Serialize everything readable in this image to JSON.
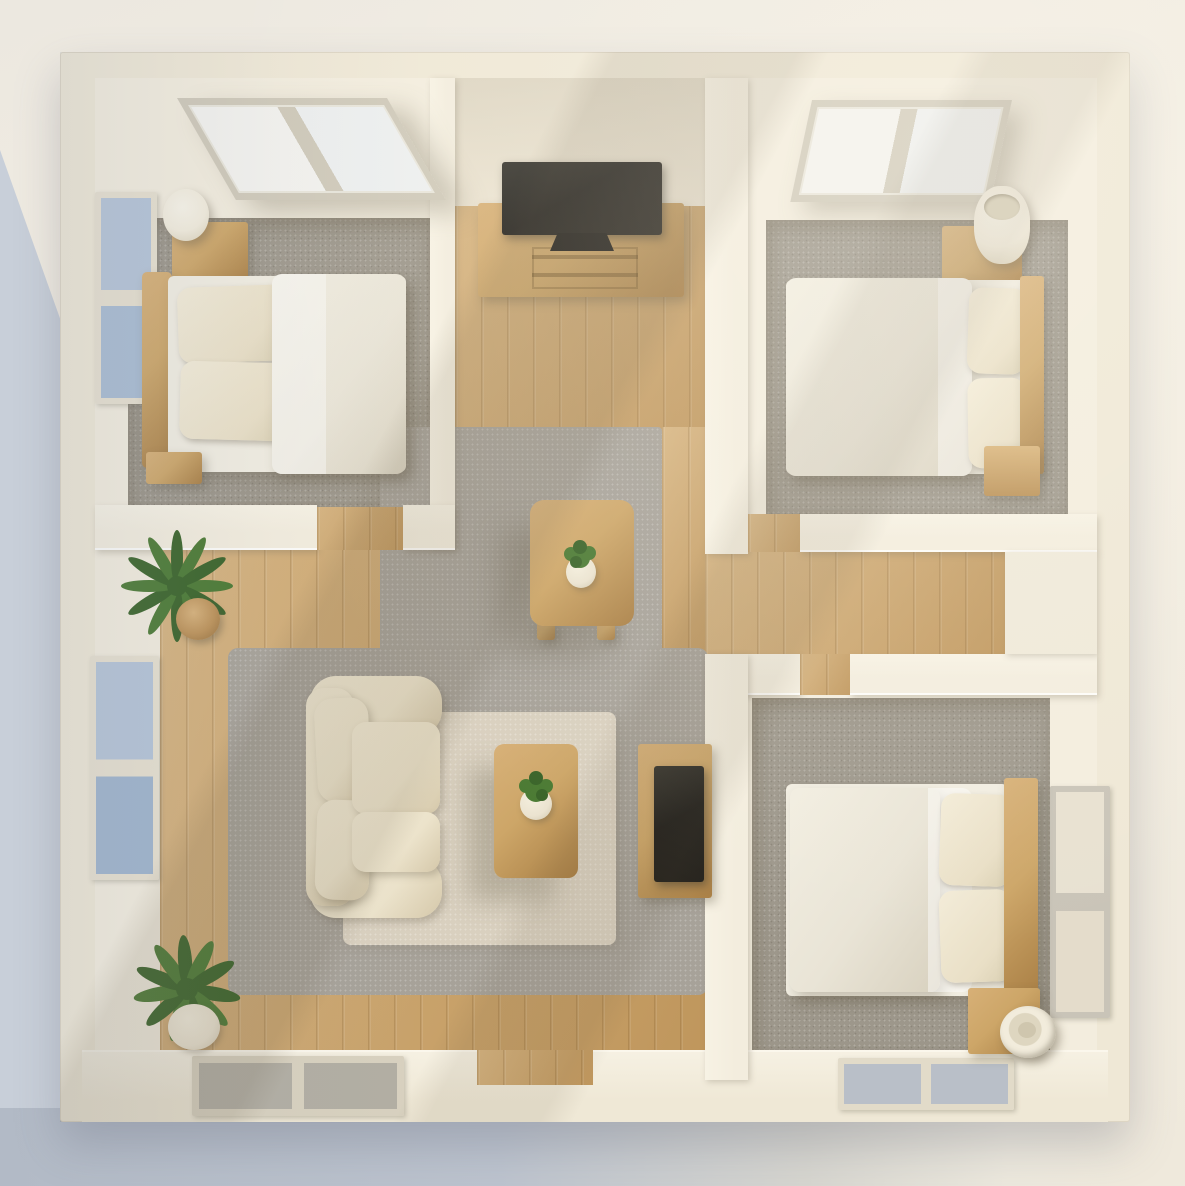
{
  "scene": {
    "title": "3D top-down floor plan render of a small apartment",
    "render_style": "photorealistic top-down axonometric, no visible text",
    "rooms": [
      {
        "id": "bedroom-top-left",
        "label": "Bedroom (top-left)",
        "floor": "gray carpet",
        "items": [
          "skylight window (2 panes)",
          "left wall window",
          "wood nightstand",
          "white table lamp",
          "double bed with wood headboard, two cream pillows, light duvet"
        ]
      },
      {
        "id": "tv-nook",
        "label": "TV nook (top-center)",
        "floor": "wood planks",
        "items": [
          "flat-screen TV",
          "wood TV console with drawers"
        ]
      },
      {
        "id": "bedroom-top-right",
        "label": "Bedroom (top-right)",
        "floor": "gray carpet",
        "items": [
          "skylight window (2 panes)",
          "wood nightstand",
          "white cylinder lamp",
          "double bed with wood headboard on right",
          "small wood cube table"
        ]
      },
      {
        "id": "central-area",
        "label": "Central dining area",
        "floor": "gray rug over wood",
        "items": [
          "square wood dining table",
          "small potted plant"
        ]
      },
      {
        "id": "living-room",
        "label": "Living room (center-bottom)",
        "floor": "gray rug + beige area rug",
        "items": [
          "cream fabric sofa",
          "wood coffee table",
          "small potted plant",
          "wood media sideboard with dark screen"
        ]
      },
      {
        "id": "hallway-left",
        "label": "Left hallway",
        "floor": "wood planks",
        "items": [
          "potted palm plant",
          "potted fern plant",
          "two left wall windows",
          "floor-level window in bottom wall"
        ]
      },
      {
        "id": "hallway-right",
        "label": "Right hallway",
        "floor": "wood planks",
        "items": [
          "doorways to both right bedrooms"
        ]
      },
      {
        "id": "bedroom-bottom-right",
        "label": "Bedroom (bottom-right)",
        "floor": "gray carpet",
        "items": [
          "double bed with wood headboard on right",
          "wood nightstand",
          "white cylinder lamp lying at an angle",
          "right wall window",
          "floor-level window in bottom wall"
        ]
      }
    ],
    "palette": {
      "bg_shadow": "#c8cfd9",
      "outer_wall": "#efe8d6",
      "wall": "#f3edde",
      "wood": "#c9a065",
      "carpet": "#9d978b",
      "rug_gray": "#a7a299",
      "rug_beige": "#d9d0bf",
      "sofa": "#ece3cb",
      "sofa_shade": "#d5c8aa",
      "fur_wood": "#cda668",
      "fur_wood_dark": "#a97f45",
      "tv": "#201e1a",
      "bedding": "#e9e4d6",
      "bedding_shade": "#d8d1bf",
      "pillow": "#e9dfc6",
      "glass_blue": "#b5c4d7",
      "glass_warm": "#e8e1d1",
      "glass_gray": "#b2aea3",
      "glass_slate": "#b9bfc8",
      "frame": "#e7e0cf",
      "lamp": "#f2ecdc",
      "plant": "#4b7a33",
      "plant_dark": "#3a6429",
      "pot_wood": "#bd9258",
      "pot_white": "#ebe3d0"
    }
  }
}
